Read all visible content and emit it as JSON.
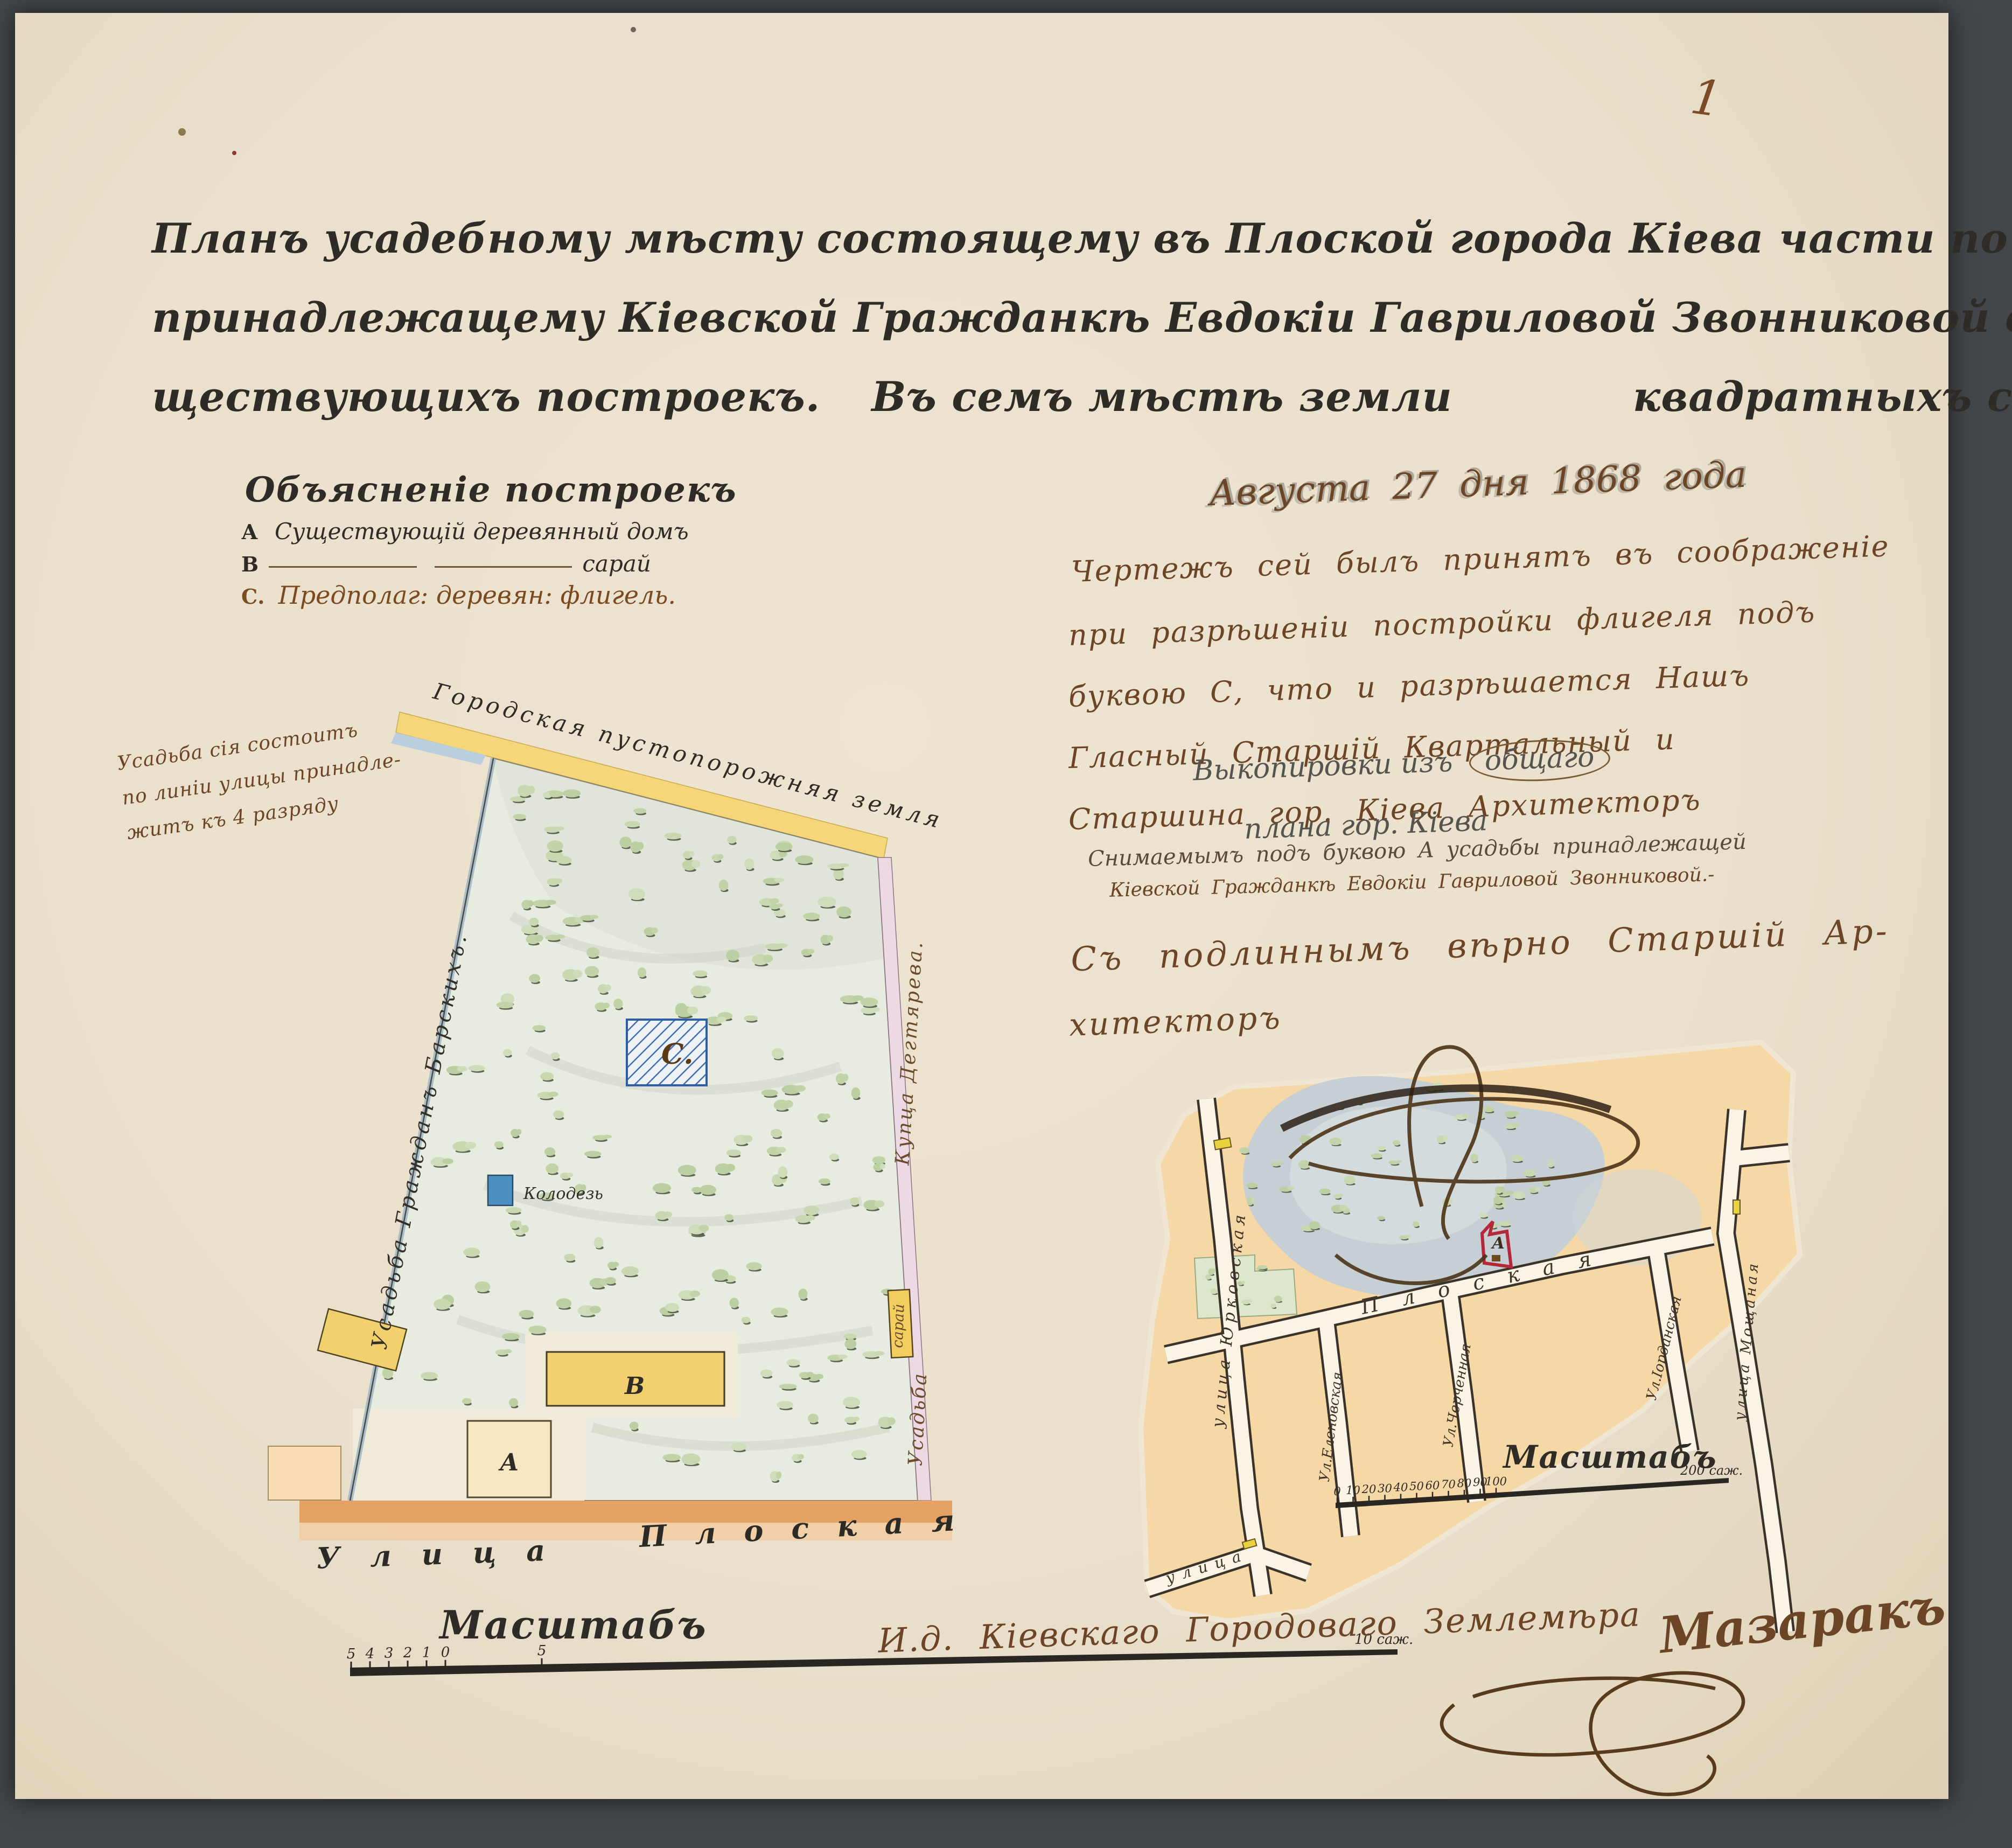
{
  "page": {
    "corner_number": "1"
  },
  "colors": {
    "paper": "#ebe2cf",
    "ink_black": "#2f2b26",
    "ink_brown": "#6b4526",
    "pencil_grey": "#63625e",
    "band_yellow": "#f6d67a",
    "block_orange": "#f6d8a6",
    "street_orange": "#e4a265",
    "plot_green": "#e8ece0",
    "bush_green": "#c7d6ae",
    "well_blue": "#4b90c1",
    "pond_grey": "#c5ced2",
    "boundary_pink": "#ecd9e3",
    "parcel_red": "#b5283a"
  },
  "title": {
    "line1": "Планъ усадебному мѣсту состоящему въ Плоской города Кіева части по Плоской улицѣ",
    "line2": "принадлежащему Кіевской Гражданкѣ Евдокіи Гавриловой Звонниковой съ означеніемъ су",
    "line3_left": "ществующихъ построекъ.",
    "line3_mid": "Въ семъ мѣстѣ земли",
    "line3_right": "квадратныхъ саженъ"
  },
  "legend": {
    "heading": "Объясненіе построекъ",
    "item_a_key": "А",
    "item_a_text": "Существующій деревянный домъ",
    "item_b_key": "В",
    "item_b_text": "сарай",
    "item_c_key": "С.",
    "item_c_text": "Предполаг: деревян: флигель."
  },
  "side_note": {
    "line1": "Усадьба сія состоитъ",
    "line2": "по линіи улицы принадле-",
    "line3": "житъ къ 4 разряду"
  },
  "main_plan": {
    "top_edge_label": "Городская пустопорожняя земля",
    "left_edge_label": "Усадьба Гражданъ Барскихъ.",
    "right_edge_owner": "Купца Дегтярева.",
    "right_edge_usadba": "Усадьба",
    "shed_label": "сарай",
    "well_label": "Колодезь",
    "building_a": "А",
    "building_b": "В",
    "building_c": "С.",
    "street_word1": "Улица",
    "street_word2": "Плоская",
    "scale_heading": "Масштабъ",
    "scale_ticks": [
      "5",
      "4",
      "3",
      "2",
      "1",
      "0",
      "5"
    ],
    "scale_end": "10 саж."
  },
  "memo": {
    "date": "Августа 27 дня 1868 года",
    "line1": "Чертежъ сей былъ принятъ въ соображеніе",
    "line2": "при разрѣшеніи постройки флигеля подъ",
    "line3": "буквою С, что и разрѣшается Нашъ",
    "line4": "Гласный Старшій Квартальный и",
    "line5": "Старшина гор. Кіева Архитекторъ",
    "overlay_line1a": "Выкопировки изъ",
    "overlay_line1b": "общаго",
    "overlay_line2": "плана гор. Кіева",
    "caption1": "Снимаемымъ подъ буквою А усадьбы принадлежащей",
    "caption2": "Кіевской Гражданкѣ Евдокіи Гавриловой Звонниковой.-",
    "verify1": "Съ подлиннымъ вѣрно Старшій Ар-",
    "verify2": "хитекторъ"
  },
  "small_map": {
    "street_left": "улица Юрковская",
    "street_diag": "улица",
    "street_main": "Плоская",
    "cross1": "Ул.Еленовская",
    "cross2": "Ул.Черченная",
    "cross3": "Ул.Іорданская",
    "street_right": "улица Мощаная",
    "parcel": "А",
    "scale_heading": "Масштабъ",
    "scale_ticks": [
      "0",
      "10",
      "20",
      "30",
      "40",
      "50",
      "60",
      "70",
      "80",
      "90",
      "100"
    ],
    "scale_end": "200 саж."
  },
  "footer": {
    "role": "И.д. Кіевскаго Городоваго Землемѣра",
    "signature": "Мазаракъ"
  }
}
